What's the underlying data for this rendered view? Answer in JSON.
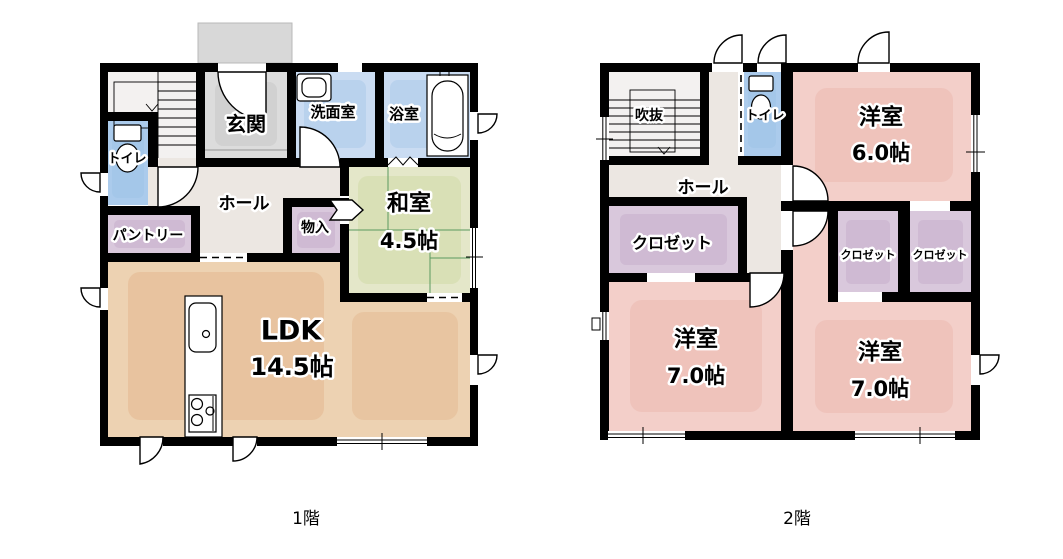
{
  "page": {
    "background": "#ffffff"
  },
  "colors": {
    "wall": "#000000",
    "ldk": "#edd2b2",
    "washitsu": "#e4e7c9",
    "tatami_line": "#5a9a60",
    "bedroom": "#f3cfc9",
    "closet": "#d9c8dc",
    "water": "#cadcf2",
    "toilet": "#abcbec",
    "hall": "#ece7e2",
    "genkan": "#dcdcdc",
    "porch": "#d8d8d8",
    "stairs": "#f3f1f0"
  },
  "floor1": {
    "caption": "1階",
    "rooms": {
      "genkan": {
        "label": "玄関"
      },
      "washroom": {
        "label": "洗面室"
      },
      "bathroom": {
        "label": "浴室"
      },
      "toilet": {
        "label": "トイレ"
      },
      "hall": {
        "label": "ホール"
      },
      "pantry": {
        "label": "パントリー"
      },
      "storage": {
        "label": "物入"
      },
      "washitsu": {
        "label": "和室",
        "size": "4.5帖"
      },
      "ldk": {
        "label": "LDK",
        "size": "14.5帖"
      }
    }
  },
  "floor2": {
    "caption": "2階",
    "rooms": {
      "void": {
        "label": "吹抜"
      },
      "toilet": {
        "label": "トイレ"
      },
      "hall": {
        "label": "ホール"
      },
      "closet": {
        "label": "クロゼット"
      },
      "closet_small_1": {
        "label": "クロゼット"
      },
      "closet_small_2": {
        "label": "クロゼット"
      },
      "bedroom6": {
        "label": "洋室",
        "size": "6.0帖"
      },
      "bedroom7a": {
        "label": "洋室",
        "size": "7.0帖"
      },
      "bedroom7b": {
        "label": "洋室",
        "size": "7.0帖"
      }
    }
  }
}
